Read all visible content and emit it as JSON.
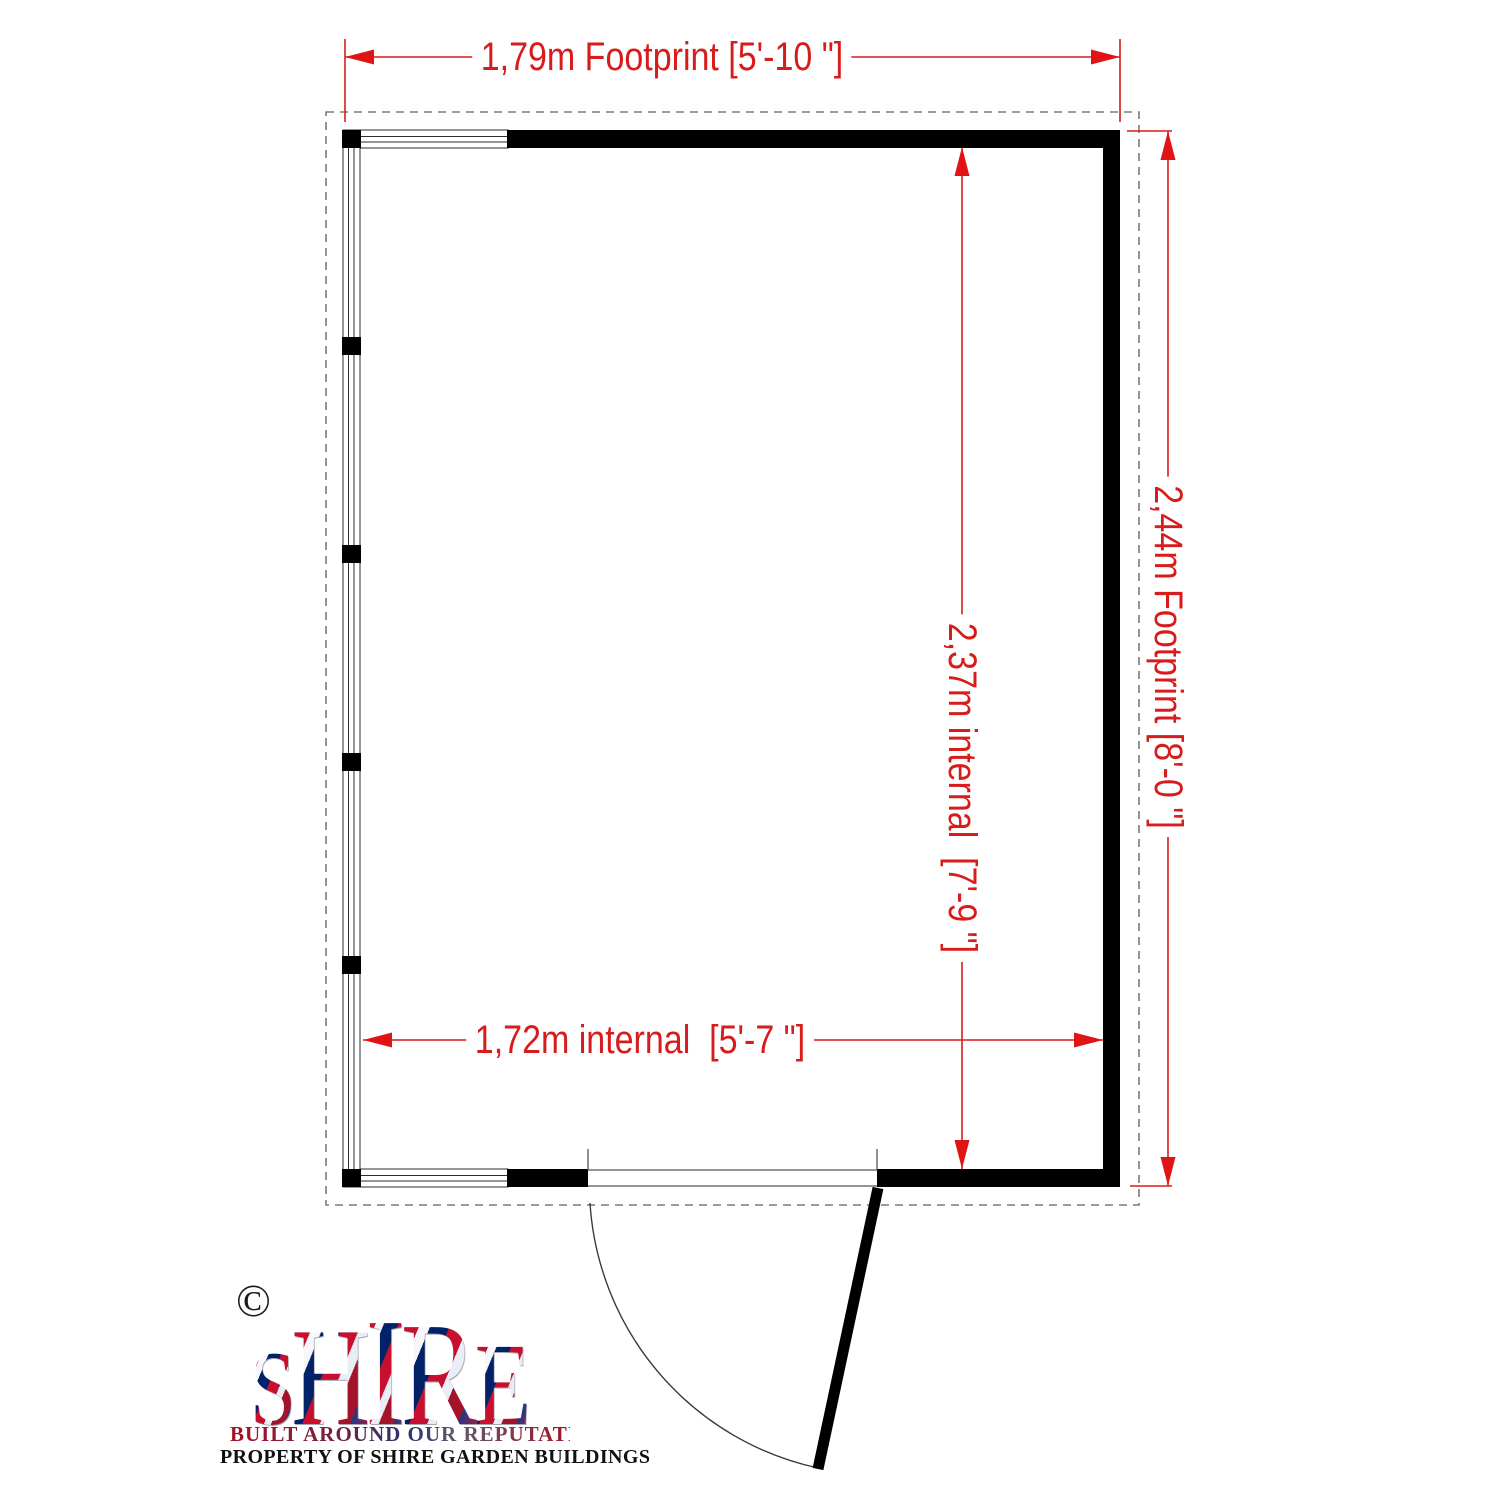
{
  "dimensions": {
    "footprint_width": "1,79m Footprint [5'-10 \"]",
    "footprint_depth": "2,44m Footprint [8'-0 \"]",
    "internal_depth": "2,37m internal  [7'-9 \"]",
    "internal_width": "1,72m internal  [5'-7 \"]"
  },
  "colors": {
    "dimension_red": "#d81c1c",
    "wall_black": "#000000",
    "base_outline_gray": "#7b7b7b",
    "flag_red": "#c8102e",
    "flag_blue": "#012169"
  },
  "logo": {
    "copyright": "©",
    "letters": [
      "S",
      "H",
      "I",
      "R",
      "E"
    ],
    "tagline": "BUILT AROUND OUR REPUTATION",
    "property_line": "PROPERTY OF SHIRE GARDEN BUILDINGS"
  }
}
